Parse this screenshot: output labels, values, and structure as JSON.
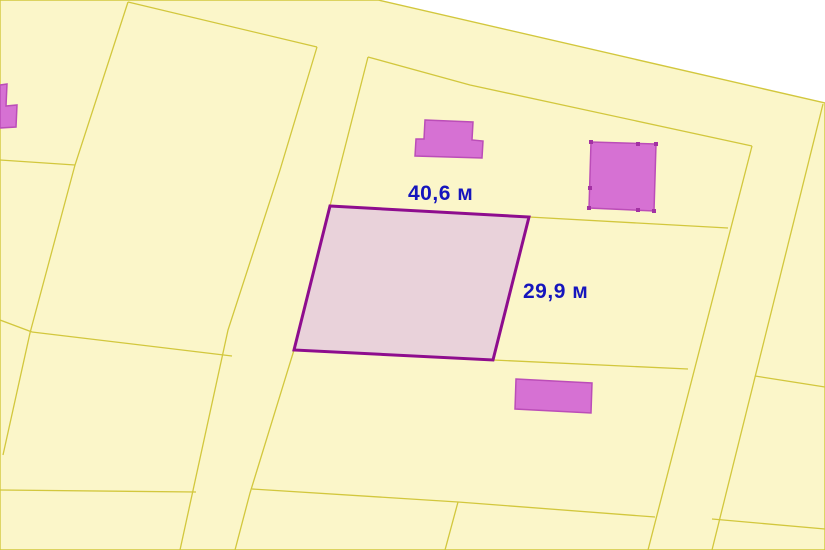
{
  "map": {
    "colors": {
      "outside": "#ffffff",
      "land": "#fbf6c9",
      "boundary": "#d2c73d",
      "selected_fill": "#e9d2da",
      "selected_stroke": "#8e0d8e",
      "building_fill": "#d671d3",
      "building_stroke": "#bb4db8",
      "building_tick": "#a332a3",
      "label_color": "#1515bd"
    },
    "labels": {
      "width": {
        "text": "40,6 м",
        "x": 408,
        "y": 182
      },
      "height": {
        "text": "29,9 м",
        "x": 523,
        "y": 280
      }
    },
    "land_outline": [
      [
        0,
        0
      ],
      [
        378,
        0
      ],
      [
        825,
        103
      ],
      [
        825,
        550
      ],
      [
        0,
        550
      ]
    ],
    "boundaries": [
      [
        [
          128,
          2
        ],
        [
          317,
          47
        ]
      ],
      [
        [
          128,
          2
        ],
        [
          75,
          165
        ],
        [
          30,
          333
        ],
        [
          3,
          455
        ]
      ],
      [
        [
          0,
          160
        ],
        [
          75,
          165
        ]
      ],
      [
        [
          0,
          320
        ],
        [
          32,
          332
        ]
      ],
      [
        [
          32,
          332
        ],
        [
          232,
          356
        ]
      ],
      [
        [
          317,
          47
        ],
        [
          280,
          170
        ],
        [
          228,
          330
        ],
        [
          180,
          550
        ]
      ],
      [
        [
          368,
          57
        ],
        [
          330,
          206
        ]
      ],
      [
        [
          294,
          350
        ],
        [
          250,
          493
        ],
        [
          235,
          550
        ]
      ],
      [
        [
          368,
          57
        ],
        [
          470,
          85
        ],
        [
          558,
          104
        ],
        [
          752,
          146
        ]
      ],
      [
        [
          529,
          217
        ],
        [
          728,
          228
        ]
      ],
      [
        [
          752,
          146
        ],
        [
          648,
          550
        ]
      ],
      [
        [
          823,
          104
        ],
        [
          712,
          550
        ]
      ],
      [
        [
          493,
          360
        ],
        [
          688,
          369
        ]
      ],
      [
        [
          755,
          376
        ],
        [
          825,
          387
        ]
      ],
      [
        [
          0,
          490
        ],
        [
          196,
          492
        ]
      ],
      [
        [
          252,
          489
        ],
        [
          458,
          502
        ],
        [
          655,
          517
        ]
      ],
      [
        [
          712,
          519
        ],
        [
          825,
          529
        ]
      ],
      [
        [
          458,
          502
        ],
        [
          445,
          550
        ]
      ]
    ],
    "selected_parcel": {
      "points": [
        [
          330,
          206
        ],
        [
          529,
          217
        ],
        [
          493,
          360
        ],
        [
          294,
          350
        ]
      ]
    },
    "buildings": [
      {
        "name": "building-left-edge",
        "points": [
          [
            0,
            85
          ],
          [
            7,
            84
          ],
          [
            6,
            106
          ],
          [
            17,
            105
          ],
          [
            16,
            127
          ],
          [
            0,
            128
          ]
        ]
      },
      {
        "name": "building-hat",
        "points": [
          [
            425,
            120
          ],
          [
            473,
            122
          ],
          [
            472,
            140
          ],
          [
            483,
            141
          ],
          [
            482,
            158
          ],
          [
            415,
            156
          ],
          [
            416,
            139
          ],
          [
            424,
            139
          ]
        ]
      },
      {
        "name": "building-square",
        "points": [
          [
            591,
            142
          ],
          [
            656,
            144
          ],
          [
            654,
            211
          ],
          [
            589,
            208
          ]
        ]
      },
      {
        "name": "building-small-rect",
        "points": [
          [
            516,
            379
          ],
          [
            592,
            383
          ],
          [
            591,
            413
          ],
          [
            515,
            409
          ]
        ]
      }
    ],
    "vertex_ticks": [
      [
        591,
        142
      ],
      [
        656,
        144
      ],
      [
        654,
        211
      ],
      [
        589,
        208
      ],
      [
        638,
        144
      ],
      [
        590,
        188
      ],
      [
        638,
        210
      ]
    ]
  }
}
